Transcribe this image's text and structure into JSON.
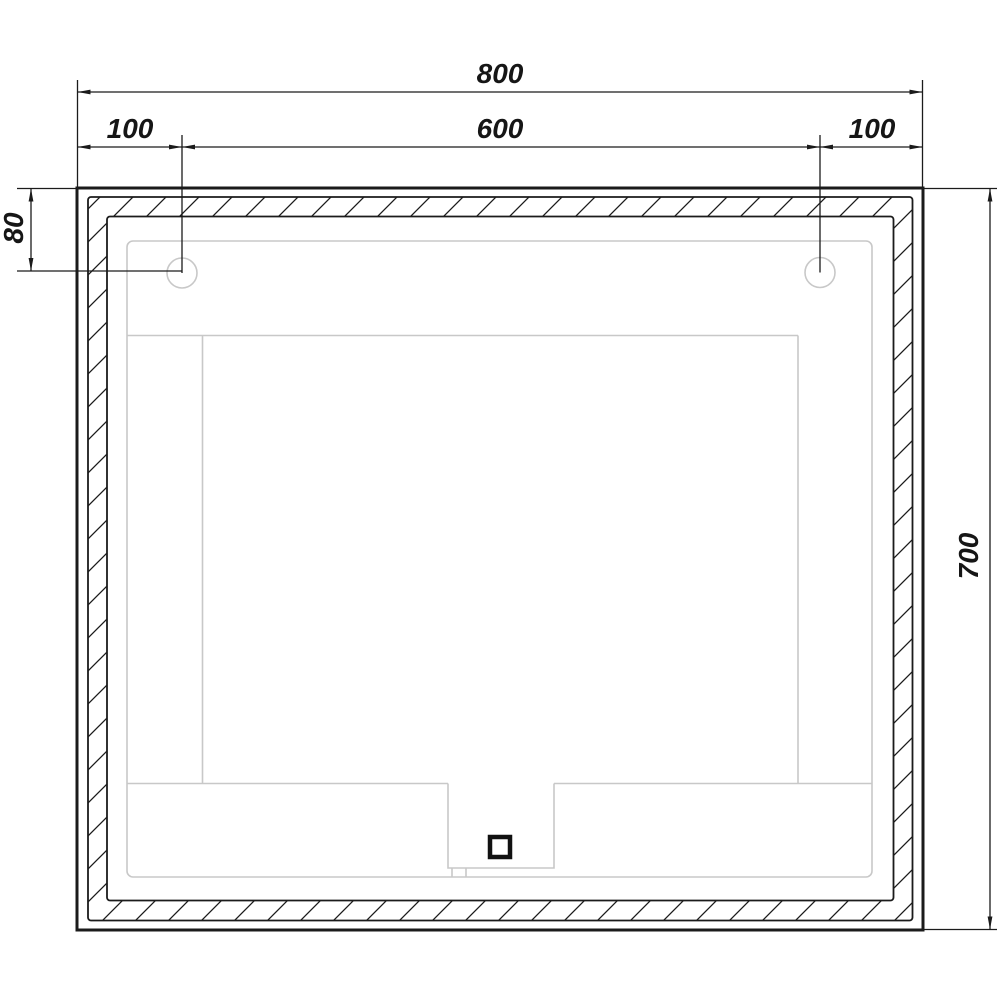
{
  "drawing": {
    "labels": {
      "overall_width": "800",
      "left_hole_offset": "100",
      "hole_spacing": "600",
      "right_hole_offset": "100",
      "hole_top_offset": "80",
      "overall_height": "700"
    },
    "colors": {
      "line": "#1b1b1b",
      "faint_line": "#c8c8c8",
      "background": "#ffffff"
    }
  }
}
